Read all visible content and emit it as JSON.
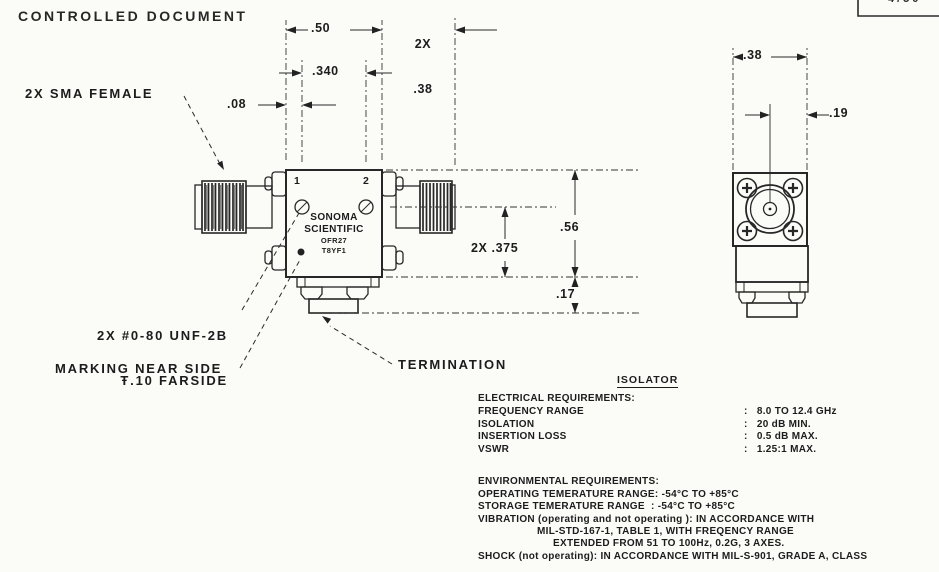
{
  "stamp": {
    "text": "CONTROLLED DOCUMENT"
  },
  "titleblock": {
    "fragment": "4/50"
  },
  "drawing": {
    "front_view": {
      "port1": "1",
      "port2": "2",
      "brand": {
        "line1": "SONOMA",
        "line2": "SCIENTIFIC",
        "line3": "OFR27",
        "line4": "T8YF1"
      }
    },
    "callouts": {
      "sma": "2X SMA FEMALE",
      "unf_line1": "2X #0-80 UNF-2B",
      "unf_line2": "Ŧ.10 FARSIDE",
      "marking": "MARKING NEAR SIDE",
      "termination": "TERMINATION"
    },
    "dimensions": {
      "body_width": ".50",
      "connector_qty": "2X",
      "connector_len": ".38",
      "screw_spacing": ".340",
      "screw_offset": ".08",
      "body_height": ".56",
      "screw_to_base": "2X .375",
      "termination_height": ".17",
      "end_width": ".38",
      "end_half_width": ".19"
    }
  },
  "specs": {
    "heading": "ISOLATOR",
    "electrical": {
      "title": "ELECTRICAL REQUIREMENTS:",
      "rows": [
        {
          "label": "FREQUENCY RANGE",
          "value": ":   8.0 TO 12.4 GHz"
        },
        {
          "label": "ISOLATION",
          "value": ":   20 dB MIN."
        },
        {
          "label": "INSERTION LOSS",
          "value": ":   0.5 dB MAX."
        },
        {
          "label": "VSWR",
          "value": ":   1.25:1 MAX."
        }
      ]
    },
    "environmental": {
      "title": "ENVIRONMENTAL REQUIREMENTS:",
      "lines": [
        "OPERATING TEMERATURE RANGE: -54°C TO +85°C",
        "STORAGE TEMERATURE RANGE  : -54°C TO +85°C",
        "VIBRATION (operating and not operating ): IN ACCORDANCE WITH",
        "MIL-STD-167-1, TABLE 1, WITH FREQENCY RANGE",
        "EXTENDED FROM 51 TO 100Hz, 0.2G, 3 AXES.",
        "SHOCK (not operating): IN ACCORDANCE WITH MIL-S-901, GRADE A, CLASS"
      ]
    }
  }
}
